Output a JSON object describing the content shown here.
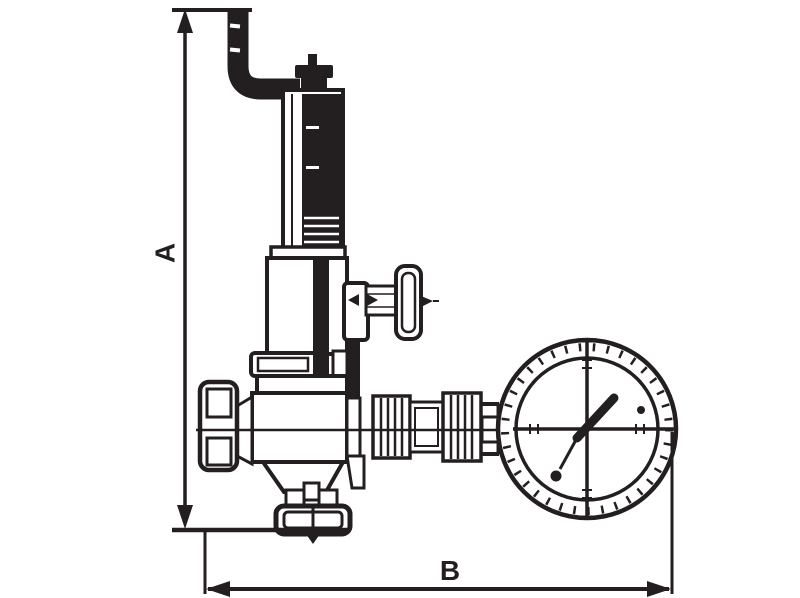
{
  "page": {
    "type": "technical-line-drawing",
    "subject": "pressure reducing valve with relief pipe, bypass tap and pressure gauge, shown with overall dimension callouts"
  },
  "colors": {
    "line": "#231f20",
    "background": "#ffffff"
  },
  "dimensions": {
    "a": {
      "label": "A",
      "orientation": "vertical"
    },
    "b": {
      "label": "B",
      "orientation": "horizontal"
    }
  },
  "components": [
    "relief-pipe",
    "adjusting-cap",
    "spring-housing",
    "bonnet",
    "bonnet-flange",
    "bypass-tap-handle",
    "valve-body",
    "inlet-union",
    "outlet-nipple",
    "gauge-union-nut",
    "pressure-gauge",
    "gauge-needle",
    "lower-body",
    "bottom-flange"
  ]
}
